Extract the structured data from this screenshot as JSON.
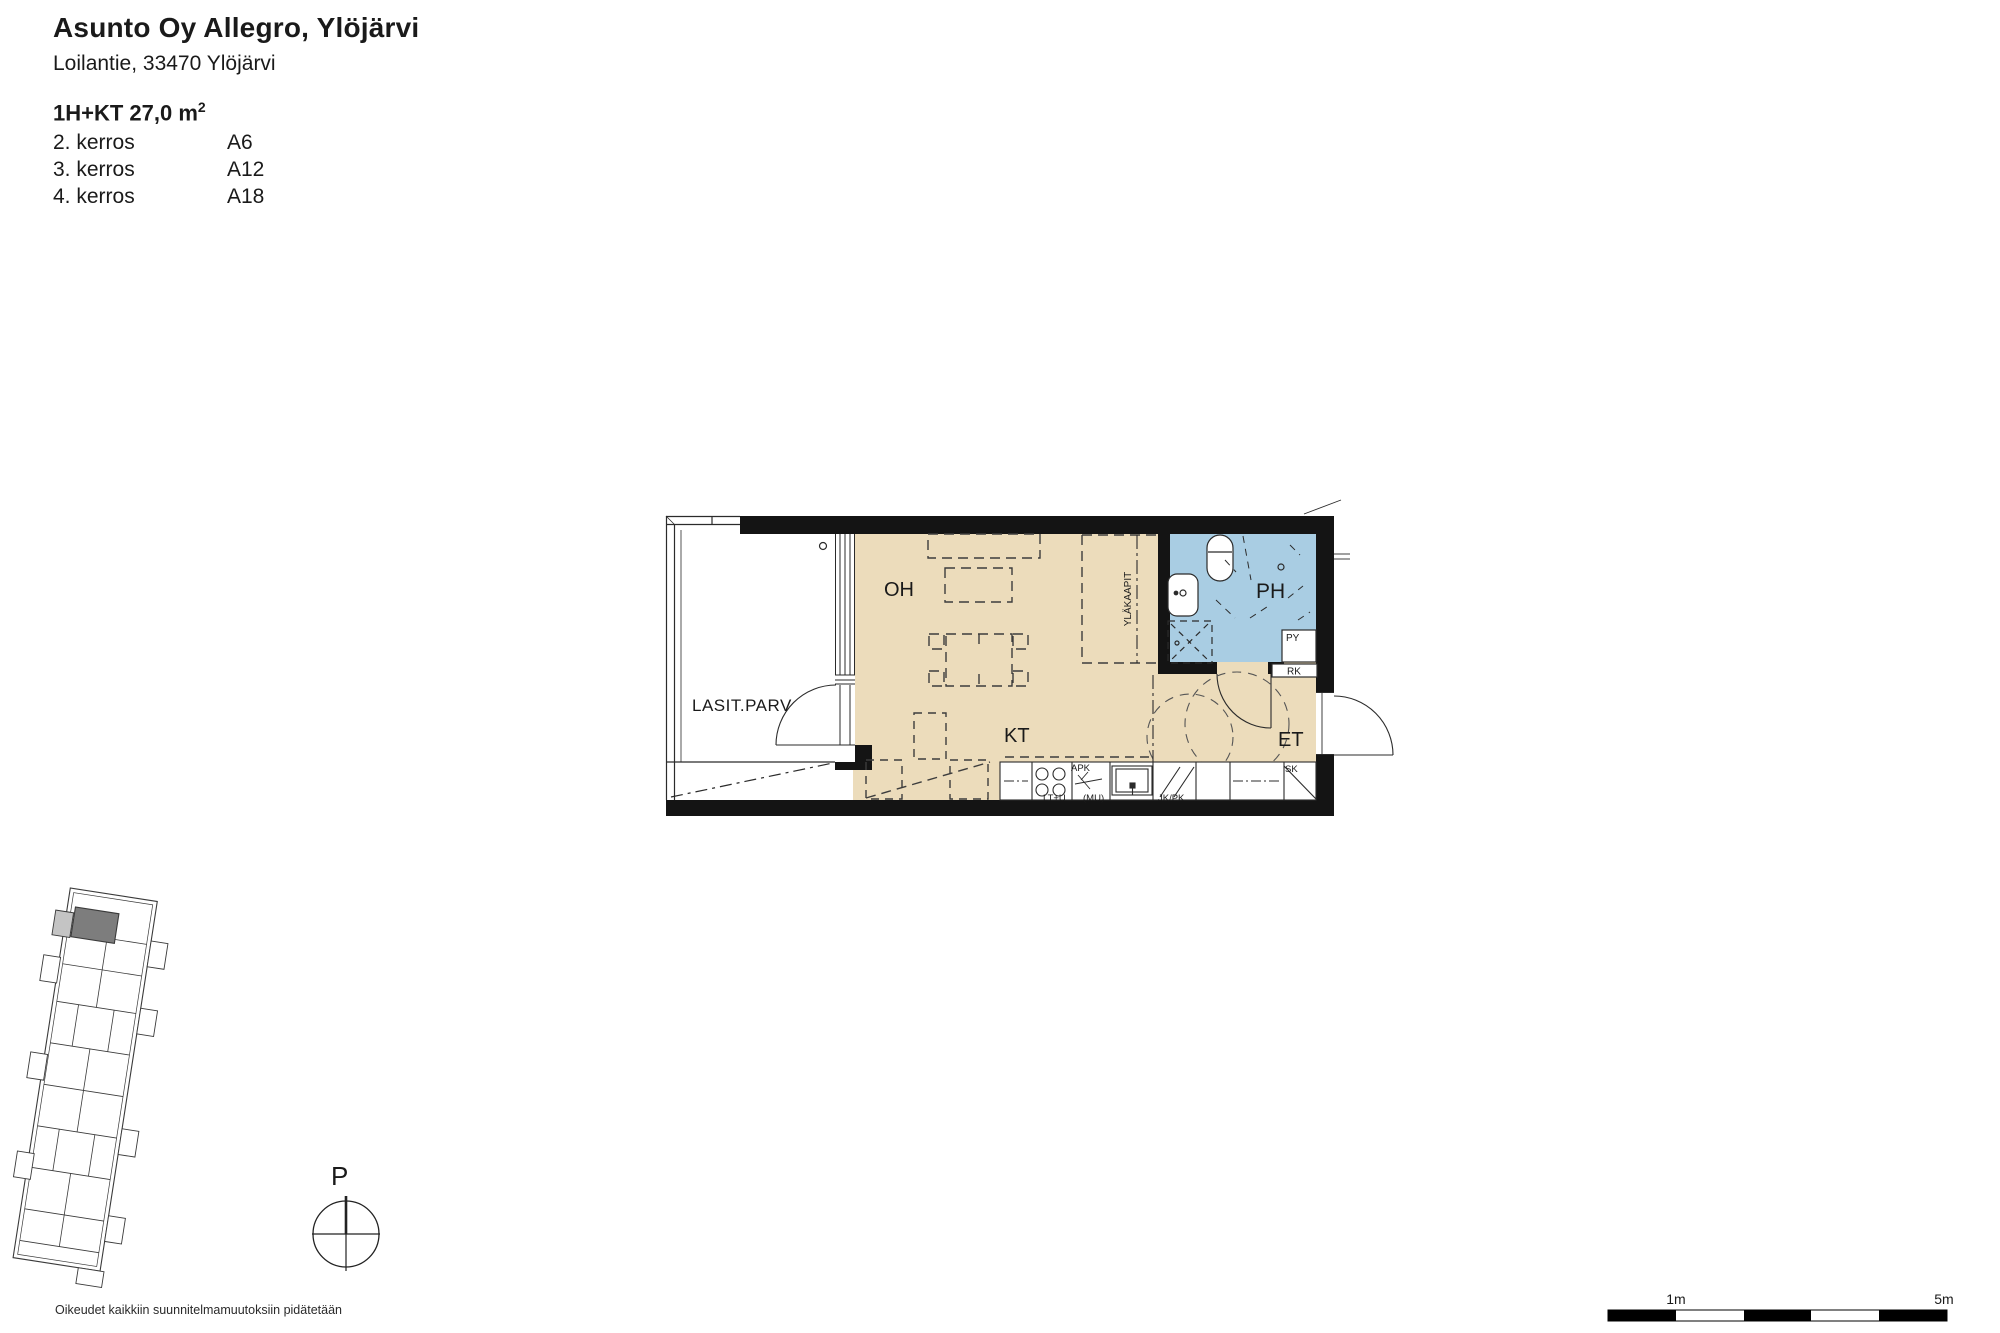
{
  "header": {
    "title": "Asunto Oy Allegro, Ylöjärvi",
    "address": "Loilantie, 33470 Ylöjärvi",
    "apartment_type": "1H+KT 27,0 m",
    "area_superscript": "2",
    "floors": [
      {
        "floor": "2. kerros",
        "unit": "A6"
      },
      {
        "floor": "3. kerros",
        "unit": "A12"
      },
      {
        "floor": "4. kerros",
        "unit": "A18"
      }
    ]
  },
  "floor_plan": {
    "room_labels": {
      "balcony": "LASIT.PARV",
      "living_room": "OH",
      "kitchen": "KT",
      "bathroom": "PH",
      "entrance": "ET"
    },
    "fixture_labels": {
      "upper_cabinets": "YLÄKAAPIT",
      "dishwasher": "APK",
      "stove_oven": "LT+U",
      "microwave": "(MU)",
      "fridge_freezer": "JK/PK",
      "cleaning_cabinet": "SK",
      "washer_reserve": "PY",
      "electrical_cabinet": "RK"
    },
    "colors": {
      "floor": "#ECDCBB",
      "bathroom_floor": "#A9CDE3",
      "wall": "#141414",
      "highlight_unit": "#7d7d7d",
      "highlight_balcony": "#c4c4c4"
    }
  },
  "compass": {
    "north_label": "P"
  },
  "scale_bar": {
    "one_meter": "1m",
    "five_meters": "5m"
  },
  "footer": {
    "rights_text": "Oikeudet kaikkiin suunnitelmamuutoksiin pidätetään"
  }
}
